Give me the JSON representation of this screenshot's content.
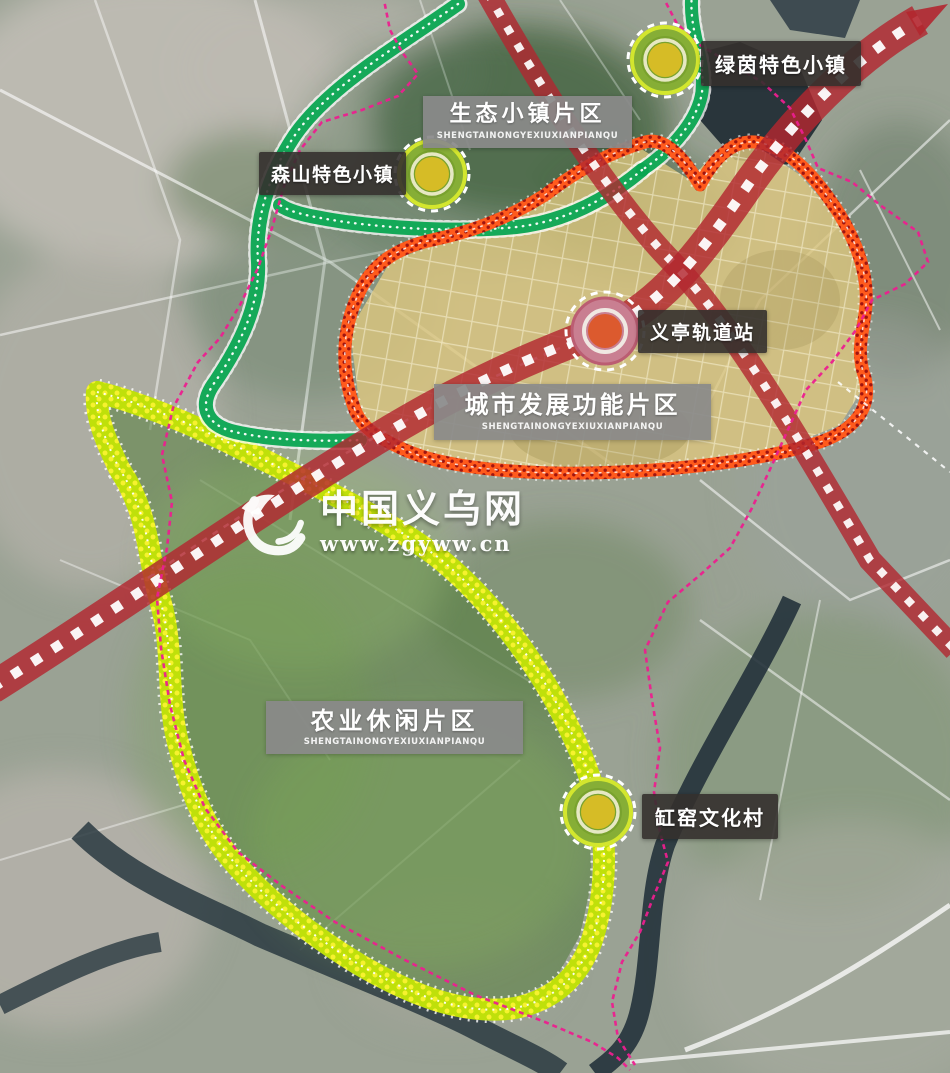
{
  "map": {
    "regions": [
      {
        "name": "生态小镇片区",
        "pinyin": "SHENGTAINONGYEXIUXIANPIANQU"
      },
      {
        "name": "城市发展功能片区",
        "pinyin": "SHENGTAINONGYEXIUXIANPIANQU"
      },
      {
        "name": "农业休闲片区",
        "pinyin": "SHENGTAINONGYEXIUXIANPIANQU"
      }
    ],
    "markers": [
      {
        "name": "绿茵特色小镇",
        "kind": "town"
      },
      {
        "name": "森山特色小镇",
        "kind": "town"
      },
      {
        "name": "义亭轨道站",
        "kind": "rail-station"
      },
      {
        "name": "缸窑文化村",
        "kind": "town"
      }
    ],
    "watermark": {
      "site_name": "中国义乌网",
      "site_url": "www.zgyww.cn"
    },
    "colors": {
      "eco_corridor": "#0aa551",
      "agri_band": "#bfe00a",
      "urban_zone": "#dcc67f",
      "urban_border": "#ff5a1c",
      "road_red": "#b22730",
      "boundary_magenta": "#ec1f8f"
    }
  }
}
